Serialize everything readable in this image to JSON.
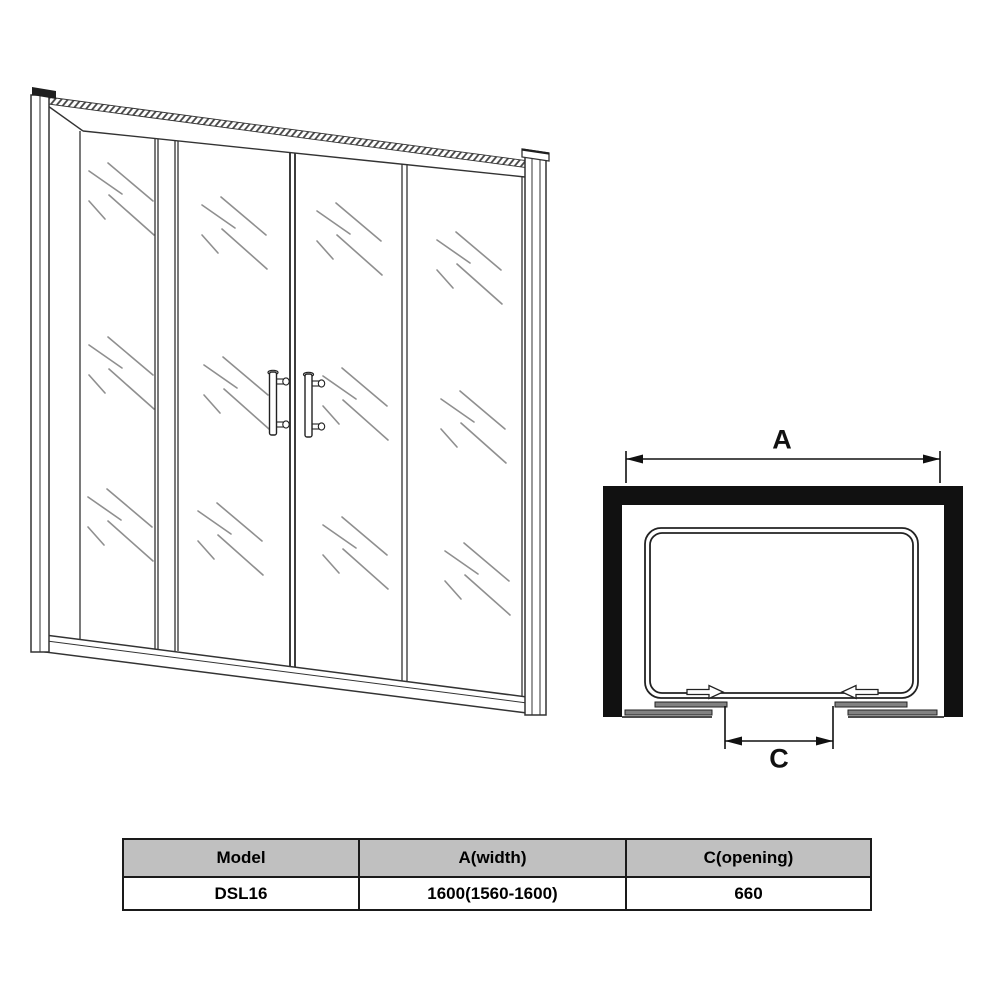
{
  "diagram": {
    "width_label": "A",
    "opening_label": "C"
  },
  "illustration": {
    "subject": "four-panel-double-sliding-shower-door",
    "panels": 4,
    "handles": 2
  },
  "table": {
    "headers": [
      "Model",
      "A(width)",
      "C(opening)"
    ],
    "rows": [
      [
        "DSL16",
        "1600(1560-1600)",
        "660"
      ]
    ]
  },
  "colors": {
    "table_header_bg": "#c0c0c0",
    "table_border": "#1a1a1a",
    "wall_black": "#111111",
    "line_dark": "#333333",
    "glass_mark_gray": "#8f8f8f",
    "panel_bar_gray": "#828282",
    "background": "#ffffff"
  }
}
